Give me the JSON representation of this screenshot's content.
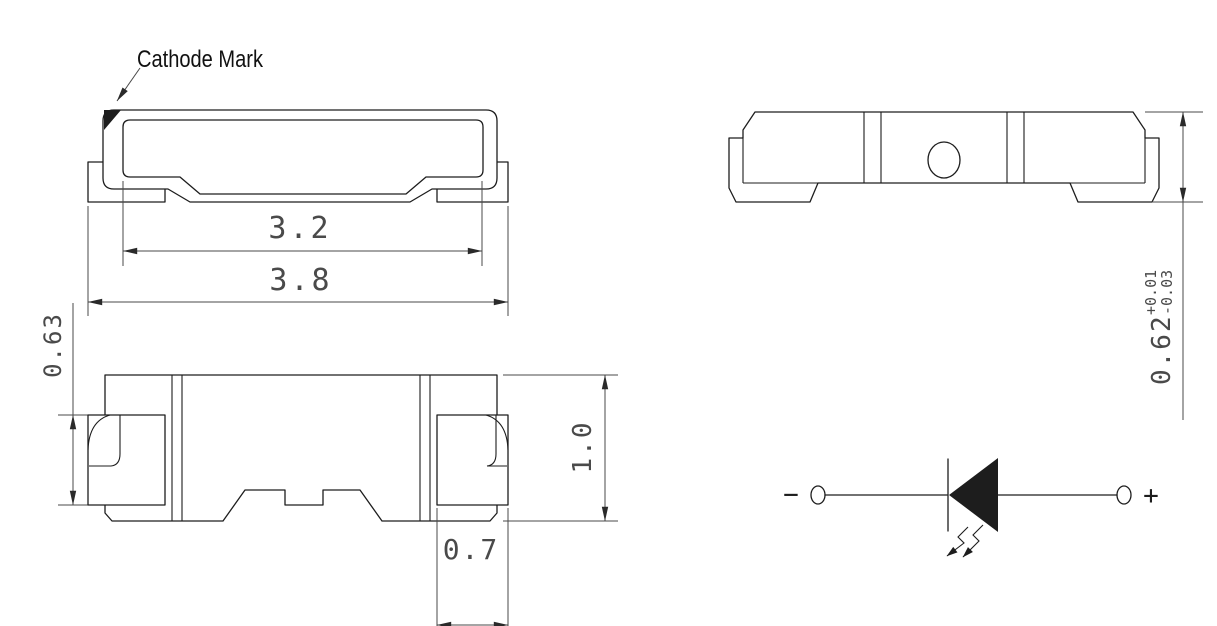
{
  "labels": {
    "cathode_mark": "Cathode Mark",
    "minus": "−",
    "plus": "+"
  },
  "dimensions": {
    "inner_width": "3.2",
    "overall_width": "3.8",
    "lead_height": "0.63",
    "body_height": "1.0",
    "pad_width": "0.7",
    "thickness": "0.62",
    "thickness_tol_plus": "+0.01",
    "thickness_tol_minus": "-0.03"
  },
  "colors": {
    "outline": "#1d1d1d",
    "dimension": "#4a4a4a",
    "background": "#ffffff"
  }
}
